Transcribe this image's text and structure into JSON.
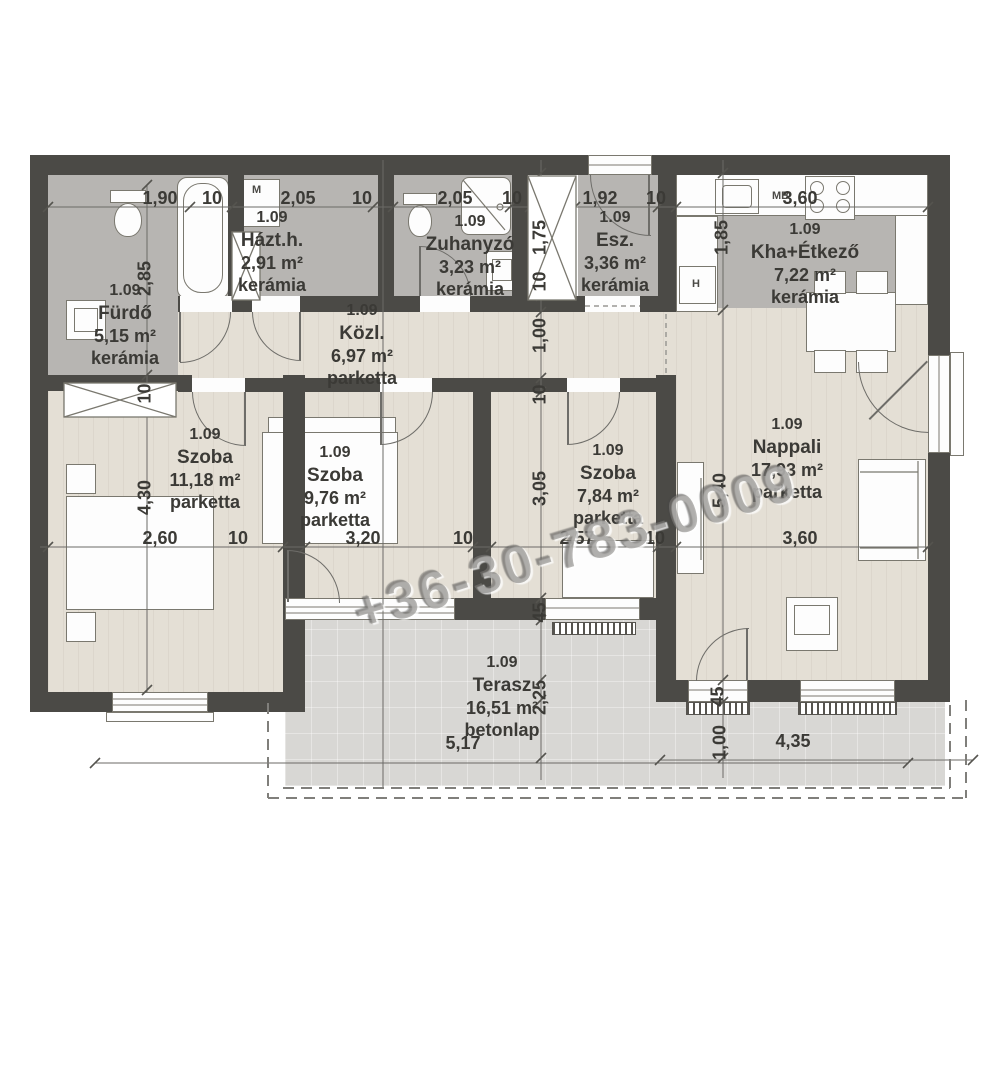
{
  "watermark": "+36-30-783-0009",
  "rooms": {
    "furdo": {
      "tag": "1.09",
      "name": "Fürdő",
      "area": "5,15 m²",
      "floor": "kerámia"
    },
    "hazth": {
      "tag": "1.09",
      "name": "Házt.h.",
      "area": "2,91 m²",
      "floor": "kerámia"
    },
    "zuhanyzo": {
      "tag": "1.09",
      "name": "Zuhanyzó",
      "area": "3,23 m²",
      "floor": "kerámia"
    },
    "esz": {
      "tag": "1.09",
      "name": "Esz.",
      "area": "3,36 m²",
      "floor": "kerámia"
    },
    "kha": {
      "tag": "1.09",
      "name": "Kha+Étkező",
      "area": "7,22 m²",
      "floor": "kerámia"
    },
    "kozl": {
      "tag": "1.09",
      "name": "Közl.",
      "area": "6,97 m²",
      "floor": "parketta"
    },
    "szoba1": {
      "tag": "1.09",
      "name": "Szoba",
      "area": "11,18 m²",
      "floor": "parketta"
    },
    "szoba2": {
      "tag": "1.09",
      "name": "Szoba",
      "area": "9,76 m²",
      "floor": "parketta"
    },
    "szoba3": {
      "tag": "1.09",
      "name": "Szoba",
      "area": "7,84 m²",
      "floor": "parketta"
    },
    "nappali": {
      "tag": "1.09",
      "name": "Nappali",
      "area": "17,93 m²",
      "floor": "parketta"
    },
    "terasz": {
      "tag": "1.09",
      "name": "Terasz",
      "area": "16,51 m²",
      "floor": "betonlap"
    }
  },
  "dimensions": {
    "top": [
      "1,90",
      "10",
      "2,05",
      "10",
      "2,05",
      "10",
      "1,92",
      "10",
      "3,60"
    ],
    "middle": [
      "2,60",
      "10",
      "3,20",
      "10",
      "2,57",
      "10",
      "3,60"
    ],
    "bottom": [
      "5,17",
      "4,35"
    ],
    "left_col": [
      "2,85",
      "10",
      "4,30"
    ],
    "center_col": [
      "1,75",
      "10",
      "1,00",
      "10",
      "3,05",
      "45",
      "2,25"
    ],
    "right_col": [
      "1,85",
      "5,40",
      "45",
      "1,00"
    ]
  },
  "appliance_labels": {
    "washer": "M",
    "sink": "MB",
    "fridge": "H"
  },
  "colors": {
    "wall": "#4b4a46",
    "ceramic": "#b7b5b2",
    "wood": "#e4dfd5",
    "terrace": "#d8d7d4"
  }
}
